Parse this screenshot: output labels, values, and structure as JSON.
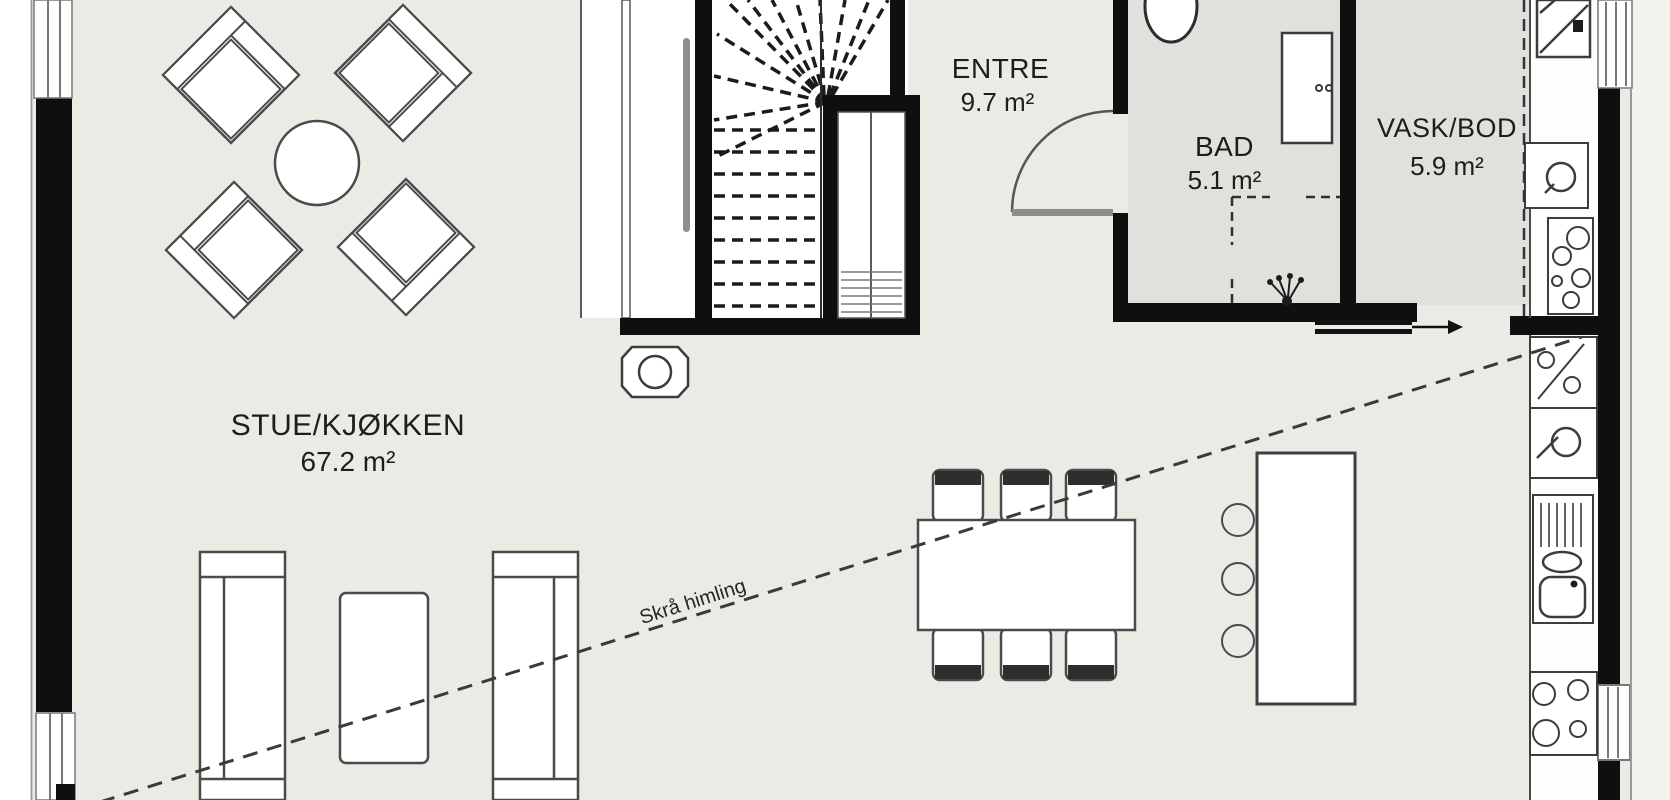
{
  "plan": {
    "title": "Floor plan",
    "rooms": [
      {
        "name": "STUE/KJØKKEN",
        "area": "67.2 m²"
      },
      {
        "name": "ENTRE",
        "area": "9.7 m²"
      },
      {
        "name": "BAD",
        "area": "5.1 m²"
      },
      {
        "name": "VASK/BOD",
        "area": "5.9 m²"
      }
    ],
    "annotations": {
      "sloped_ceiling": "Skrå himling"
    },
    "colors": {
      "wall": "#0f0f0f",
      "floor": "#eceae5",
      "wet_room_floor": "#e1e0dd",
      "fixture_white": "#ffffff",
      "outline": "#4a4a4a",
      "dashed_line": "#3a3a3a"
    },
    "furniture": [
      "armchair",
      "round-table",
      "wood-stove",
      "staircase",
      "wardrobe",
      "entrance-hall-door",
      "toilet",
      "bathroom-cabinet",
      "shower-head",
      "laundry-bench",
      "utility-sink",
      "laundry-unit",
      "dishwasher",
      "kitchen-sink",
      "cooktop",
      "kitchen-island",
      "bar-stool",
      "dining-table",
      "dining-chair",
      "sofa",
      "coffee-table",
      "sliding-door-arrow",
      "window"
    ]
  }
}
